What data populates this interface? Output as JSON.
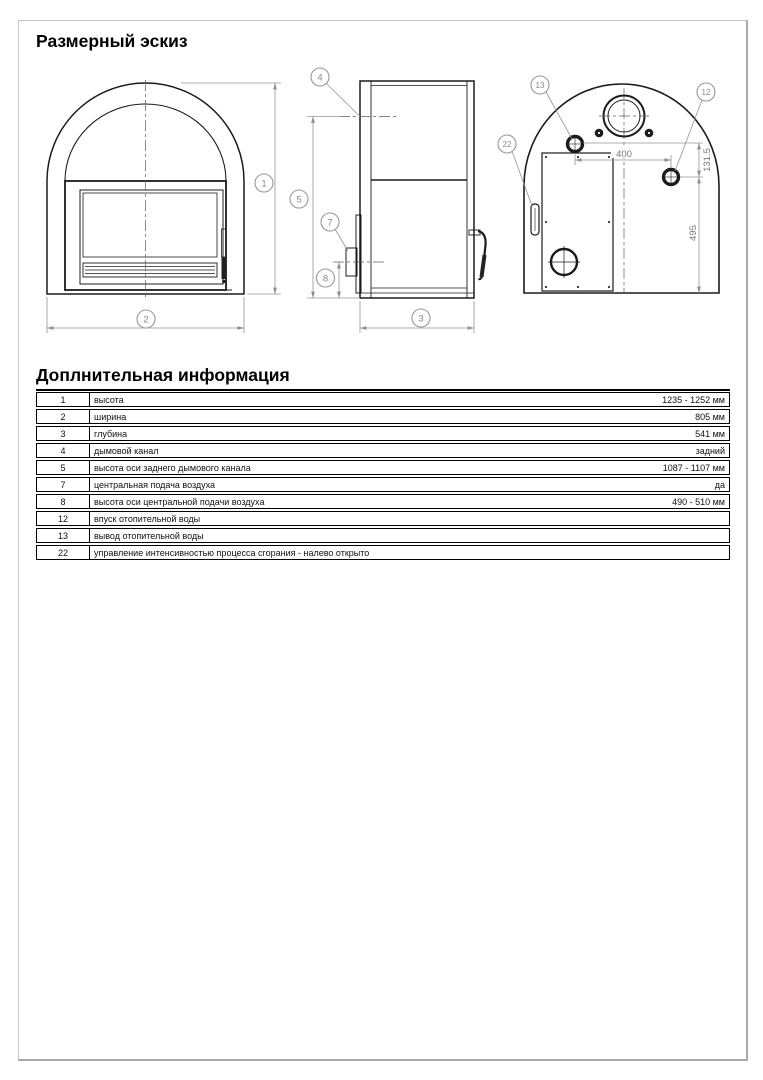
{
  "page": {
    "section1_title": "Размерный эскиз",
    "section2_title": "Доплнительная информация"
  },
  "drawing": {
    "callouts": {
      "c1": "1",
      "c2": "2",
      "c3": "3",
      "c4": "4",
      "c5": "5",
      "c7": "7",
      "c8": "8",
      "c12": "12",
      "c13": "13",
      "c22": "22"
    },
    "dimensions": {
      "rear_top_width": "400",
      "rear_inlet_offset": "131.5",
      "rear_inlet_height": "495"
    }
  },
  "table": {
    "rows": [
      {
        "num": "1",
        "label": "высота",
        "value": "1235 - 1252 мм"
      },
      {
        "num": "2",
        "label": "ширина",
        "value": "805 мм"
      },
      {
        "num": "3",
        "label": "глубина",
        "value": "541 мм"
      },
      {
        "num": "4",
        "label": "дымовой канал",
        "value": "задний"
      },
      {
        "num": "5",
        "label": "высота оси заднего дымового канала",
        "value": "1087 - 1107 мм"
      },
      {
        "num": "7",
        "label": "центральная подача воздуха",
        "value": "да"
      },
      {
        "num": "8",
        "label": "высота оси центральной подачи воздуха",
        "value": "490 - 510 мм"
      },
      {
        "num": "12",
        "label": "впуск отопительной воды",
        "value": ""
      },
      {
        "num": "13",
        "label": "вывод отопительной воды",
        "value": ""
      },
      {
        "num": "22",
        "label": "управление интенсивностью процесса сгорания - налево открыто",
        "value": ""
      }
    ]
  }
}
